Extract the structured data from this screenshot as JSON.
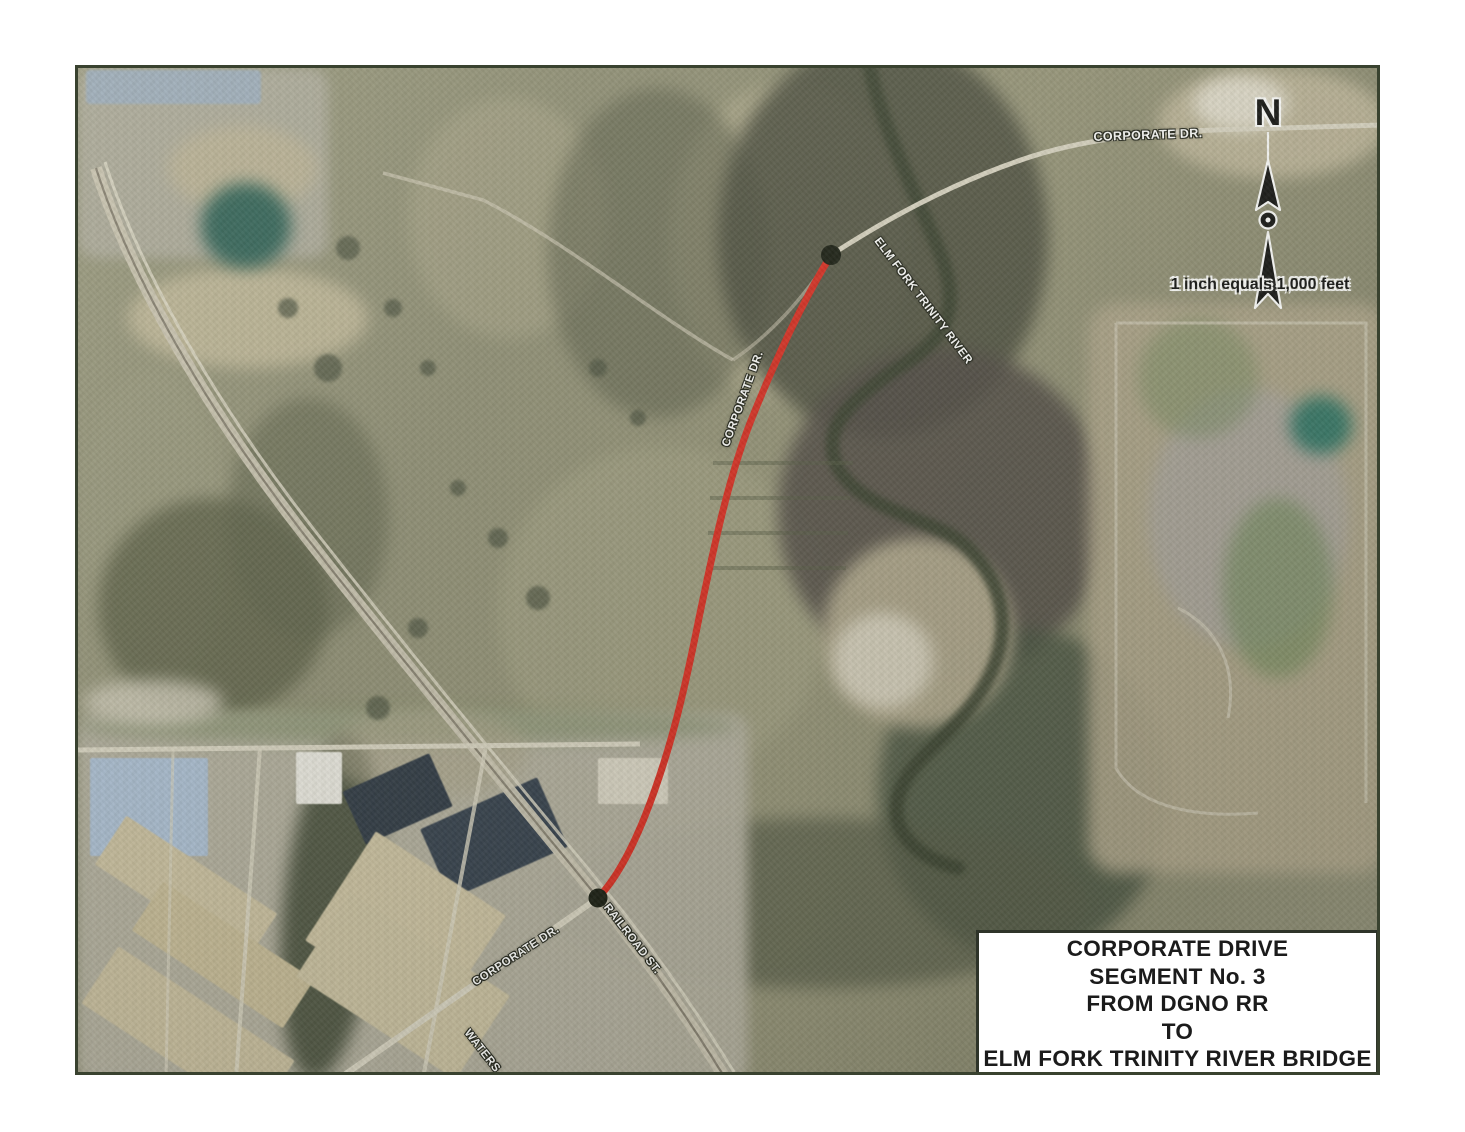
{
  "map": {
    "north_arrow": {
      "label": "N"
    },
    "scale": {
      "text": "1 inch equals 1,000 feet"
    },
    "road_labels": {
      "corporate_dr_top": "CORPORATE DR.",
      "elm_fork_trinity_river": "ELM FORK TRINITY RIVER",
      "corporate_dr_route": "CORPORATE DR.",
      "corporate_dr_sw": "CORPORATE DR.",
      "railroad_st": "RAILROAD ST.",
      "waterside_partial": "WATERS"
    },
    "title_block": {
      "lines": [
        "CORPORATE DRIVE",
        "SEGMENT No. 3",
        "FROM DGNO RR",
        "TO",
        "ELM FORK TRINITY RIVER BRIDGE"
      ]
    },
    "route": {
      "color": "#d92b20",
      "endpoint_color": "#161a10"
    },
    "colors": {
      "map_border": "#39422f",
      "title_border": "#2e3429",
      "road": "#d2ccba",
      "river": "#39402f",
      "pond_teal": "#2e7465"
    }
  }
}
